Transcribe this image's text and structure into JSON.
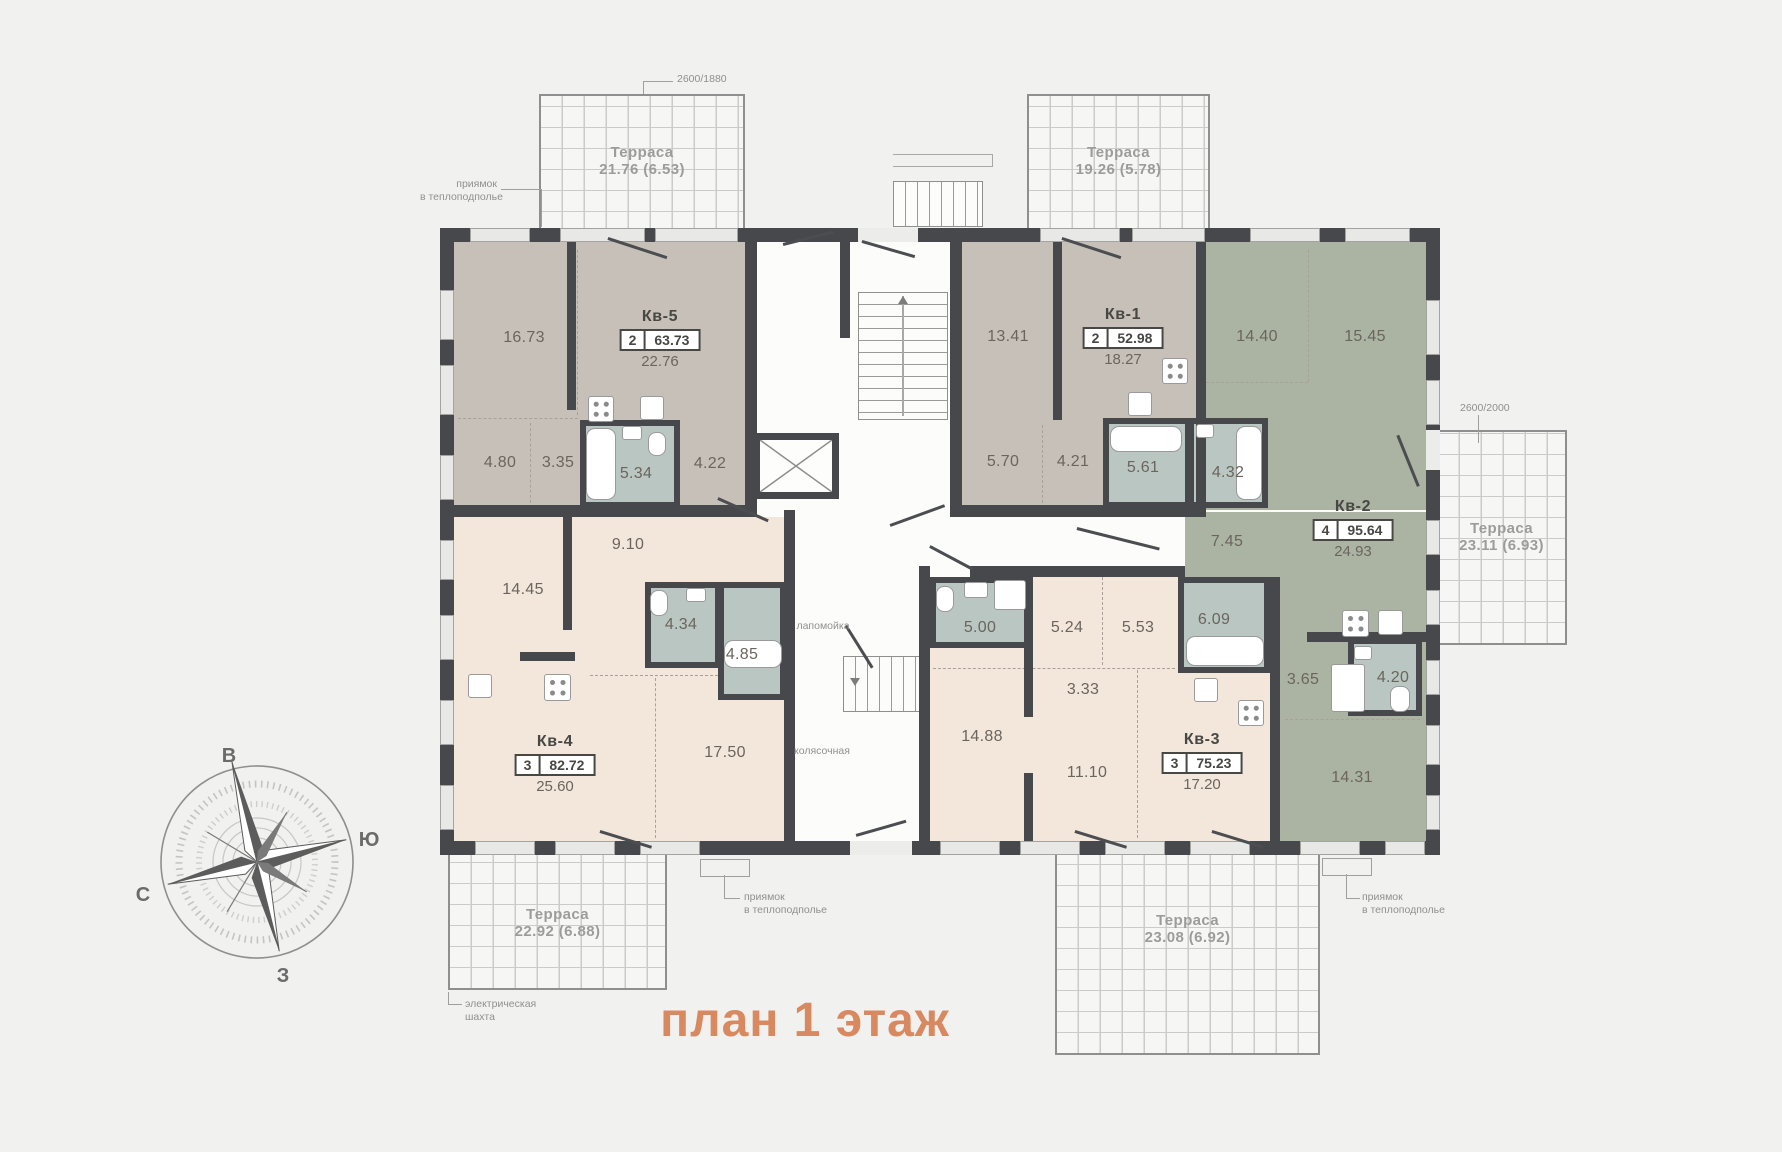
{
  "title": "план 1 этаж",
  "palette": {
    "accent": "#d9895f",
    "wall": "#46484b",
    "apartment_taupe": "#c7c0b9",
    "apartment_green": "#abb4a3",
    "apartment_beige": "#f3e7dc",
    "bathroom": "#bac6c1",
    "background": "#f1f1f0"
  },
  "compass": {
    "top": "В",
    "right": "Ю",
    "left": "С",
    "bottom": "З"
  },
  "dims": {
    "top_left": "2600/1880",
    "right": "2600/2000"
  },
  "notes": {
    "pit": {
      "line1": "приямок",
      "line2": "в теплоподполье"
    },
    "shaft": {
      "line1": "электрическая",
      "line2": "шахта"
    },
    "paw_wash": "лапомойка",
    "stroller": "колясочная"
  },
  "terraces": [
    {
      "label": "Терраса",
      "value": "21.76 (6.53)"
    },
    {
      "label": "Терраса",
      "value": "19.26 (5.78)"
    },
    {
      "label": "Терраса",
      "value": "23.11 (6.93)"
    },
    {
      "label": "Терраса",
      "value": "22.92 (6.88)"
    },
    {
      "label": "Терраса",
      "value": "23.08 (6.92)"
    }
  ],
  "apartments": {
    "kv5": {
      "name": "Кв-5",
      "rooms": "2",
      "total": "63.73",
      "kitchen": "22.76",
      "areas": [
        "16.73",
        "4.80",
        "3.35",
        "5.34",
        "4.22"
      ]
    },
    "kv1": {
      "name": "Кв-1",
      "rooms": "2",
      "total": "52.98",
      "kitchen": "18.27",
      "areas": [
        "13.41",
        "5.70",
        "4.21",
        "5.61",
        "4.32"
      ]
    },
    "kv2": {
      "name": "Кв-2",
      "rooms": "4",
      "total": "95.64",
      "kitchen": "24.93",
      "areas": [
        "14.40",
        "15.45",
        "7.45",
        "3.65",
        "4.20",
        "14.31"
      ]
    },
    "kv3": {
      "name": "Кв-3",
      "rooms": "3",
      "total": "75.23",
      "kitchen": "17.20",
      "areas": [
        "5.00",
        "5.24",
        "5.53",
        "6.09",
        "3.33",
        "14.88",
        "11.10"
      ]
    },
    "kv4": {
      "name": "Кв-4",
      "rooms": "3",
      "total": "82.72",
      "kitchen": "25.60",
      "areas": [
        "9.10",
        "14.45",
        "4.34",
        "4.85",
        "17.50"
      ]
    }
  }
}
